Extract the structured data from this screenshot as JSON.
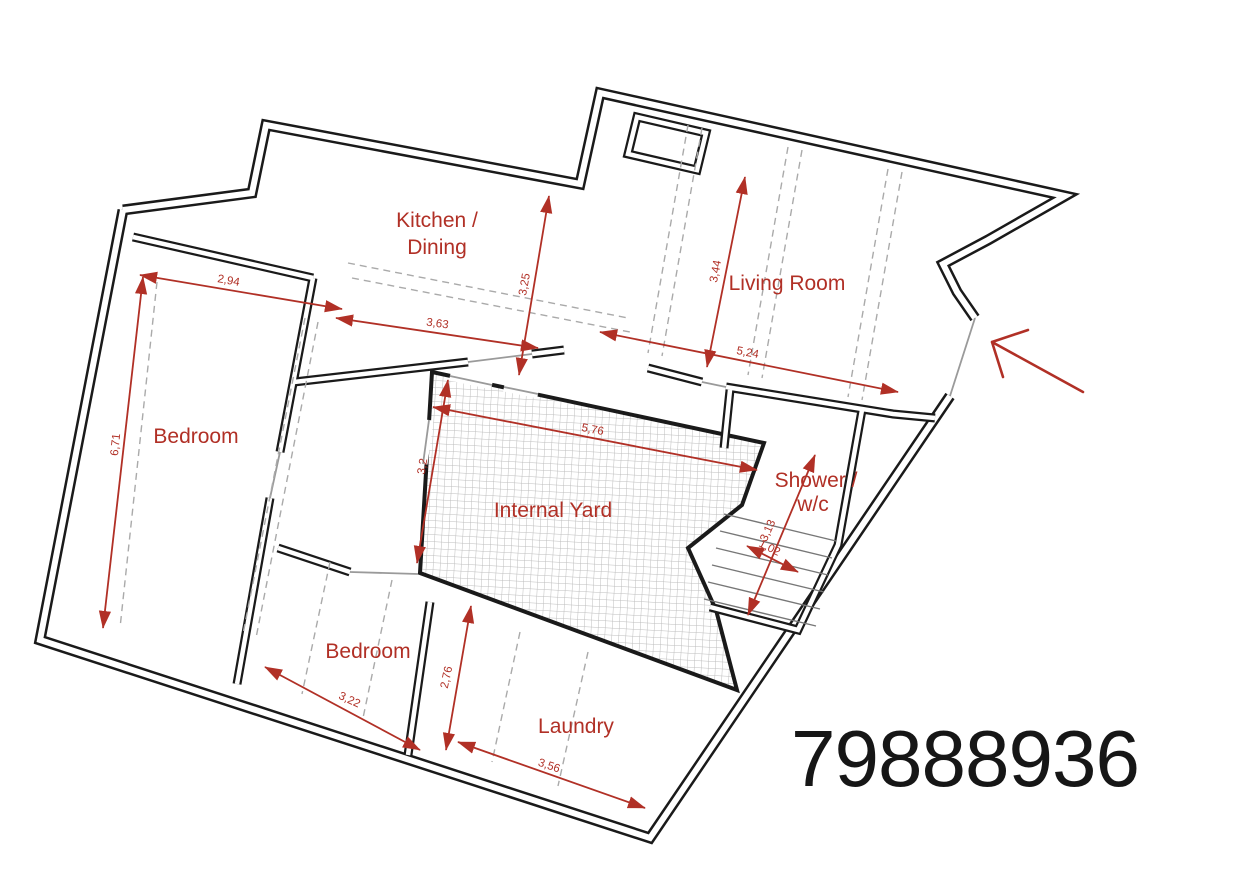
{
  "plan": {
    "number": "79888936",
    "rooms": {
      "kitchen_line1": "Kitchen /",
      "kitchen_line2": "Dining",
      "living": "Living Room",
      "bedroom_left": "Bedroom",
      "yard": "Internal Yard",
      "shower_line1": "Shower /",
      "shower_line2": "w/c",
      "bedroom_bottom": "Bedroom",
      "laundry": "Laundry"
    },
    "dimensions": {
      "bedroom_left_width": "2,94",
      "bedroom_left_length": "6,71",
      "kitchen_width": "3,63",
      "kitchen_depth": "3,25",
      "living_depth": "3,44",
      "living_width": "5,24",
      "yard_width": "5,76",
      "yard_depth": "3,2",
      "stairs_length": "3,13",
      "stairs_width": "1,02",
      "bedroom_bottom_width": "3,22",
      "bedroom_bottom_depth": "2,76",
      "laundry_width": "3,56"
    },
    "colors": {
      "annotation_red": "#b13026",
      "wall_black": "#1a1a1a",
      "hatch_gray": "#bdbdbd"
    }
  }
}
